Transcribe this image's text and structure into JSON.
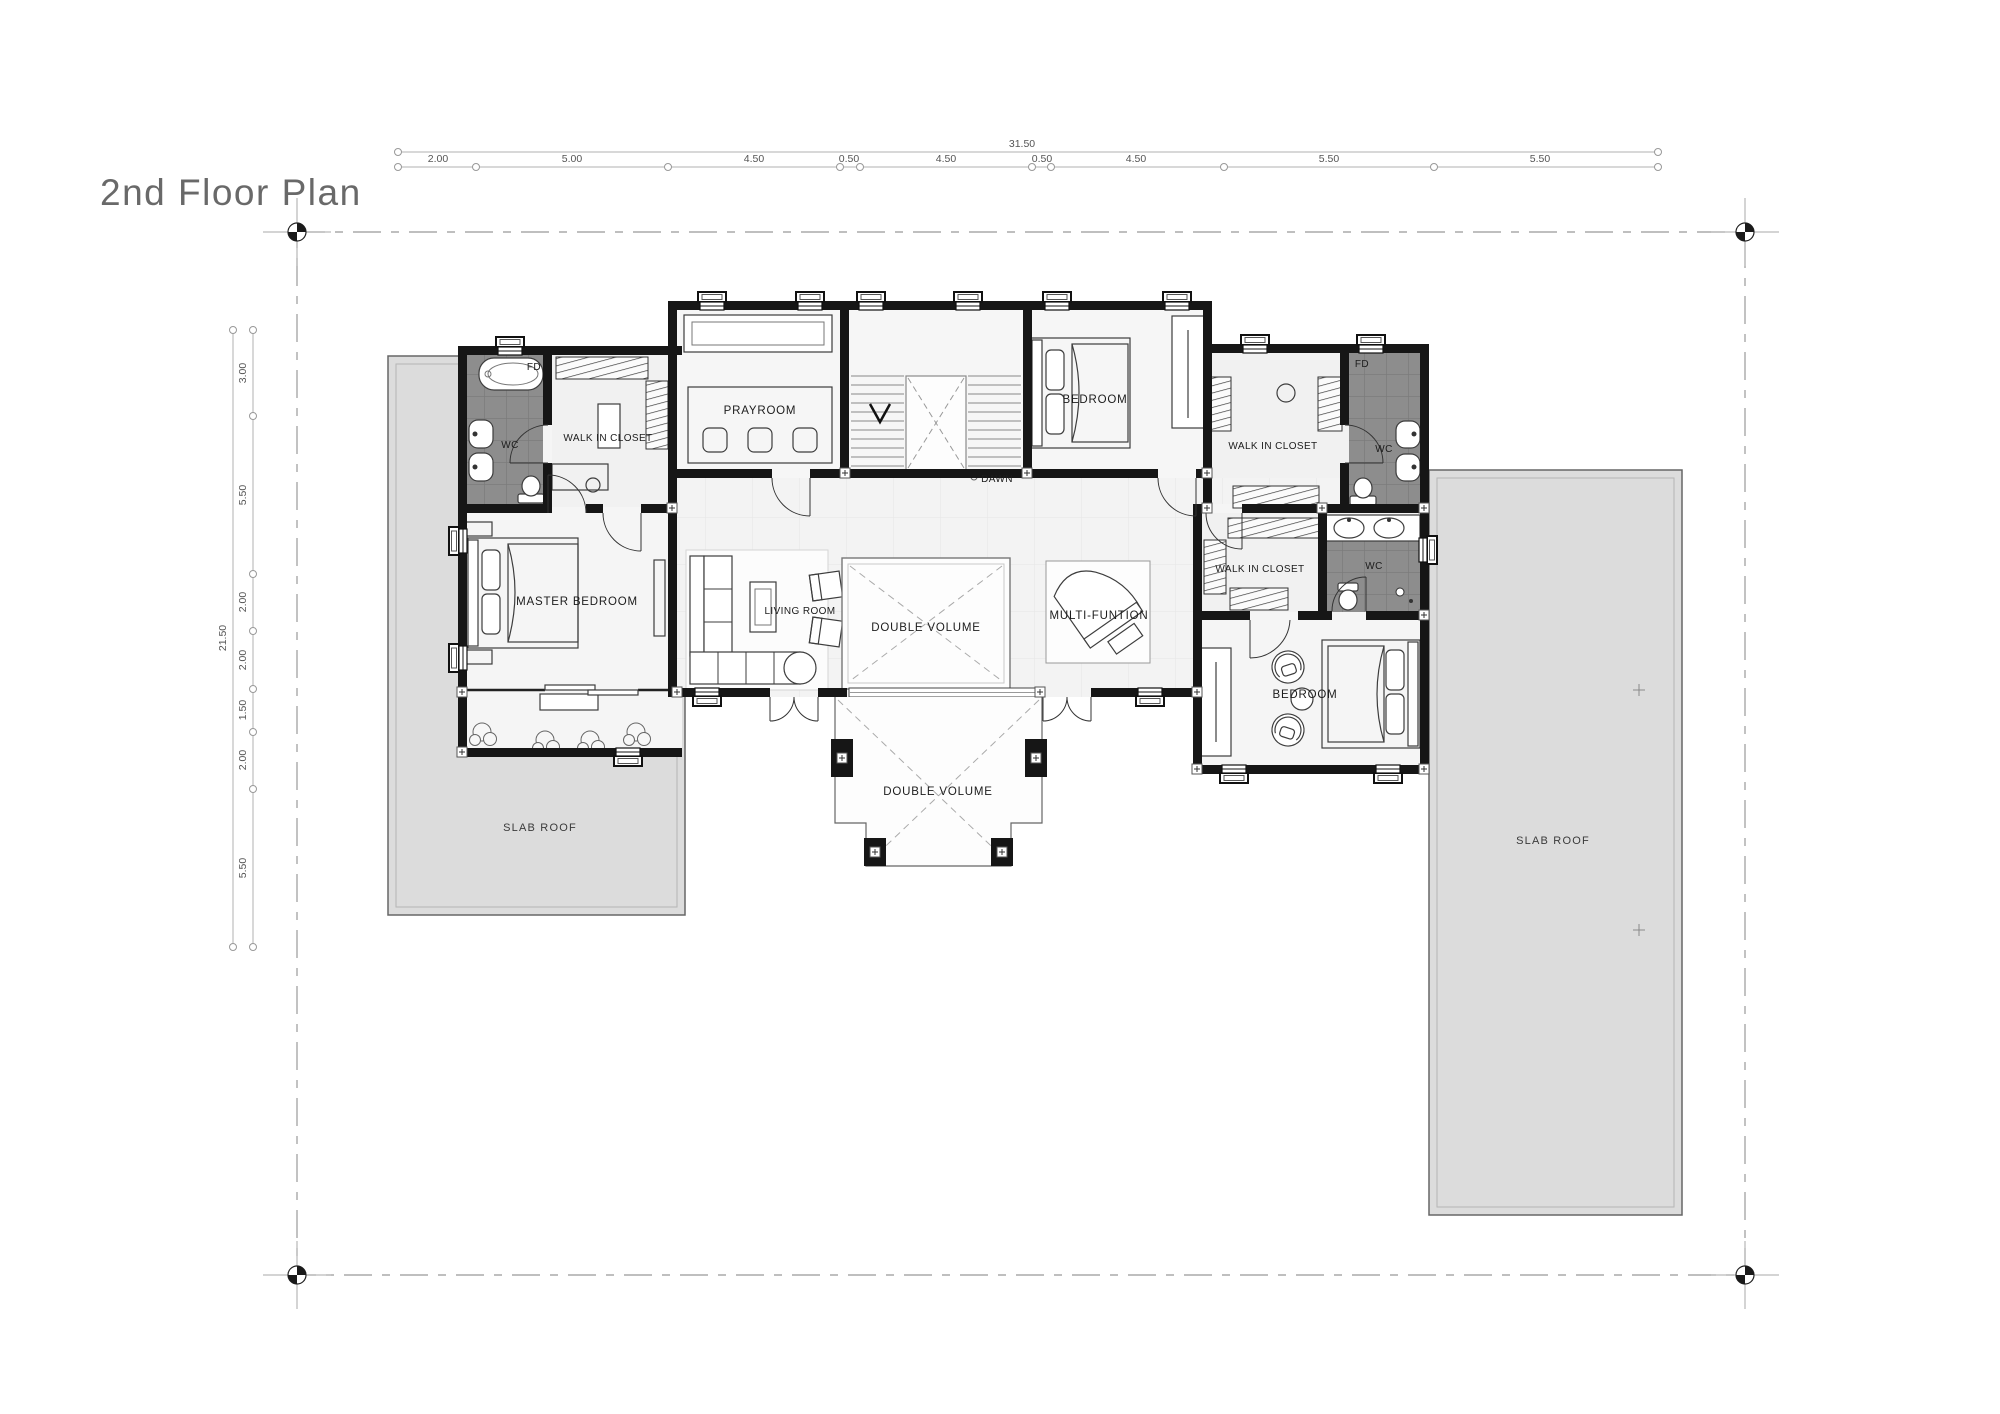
{
  "title": "2nd Floor Plan",
  "dimensions": {
    "top": {
      "total": "31.50",
      "segments": [
        "2.00",
        "5.00",
        "4.50",
        "0.50",
        "4.50",
        "0.50",
        "4.50",
        "5.50",
        "5.50"
      ]
    },
    "left": {
      "total": "21.50",
      "segments": [
        "3.00",
        "5.50",
        "2.00",
        "2.00",
        "1.50",
        "2.00",
        "5.50"
      ]
    }
  },
  "labels": {
    "prayroom": "PRAYROOM",
    "dawn": "DAWN",
    "bedroom_top": "BEDROOM",
    "bedroom_right": "BEDROOM",
    "master_bedroom": "MASTER BEDROOM",
    "living_room": "LIVING ROOM",
    "multi_function": "MULTI-FUNTION",
    "double_volume": "DOUBLE VOLUME",
    "double_volume_lower": "DOUBLE VOLUME",
    "walk_in_closet_left": "WALK IN CLOSET",
    "walk_in_closet_right": "WALK IN CLOSET",
    "walk_in_closet_small": "WALK IN CLOSET",
    "wc_left": "WC",
    "fd_left": "FD",
    "wc_right": "WC",
    "fd_right": "FD",
    "wc_small": "WC",
    "slab_roof_left": "SLAB ROOF",
    "slab_roof_right": "SLAB ROOF"
  },
  "colors": {
    "wall": "#161616",
    "bath_tile": "#8d8d8d",
    "slab_roof": "#dcdcdc",
    "floor": "#f3f3f3",
    "dim_line": "#9a9a9a",
    "title_text": "#696969",
    "label_text": "#1c1c1c"
  }
}
